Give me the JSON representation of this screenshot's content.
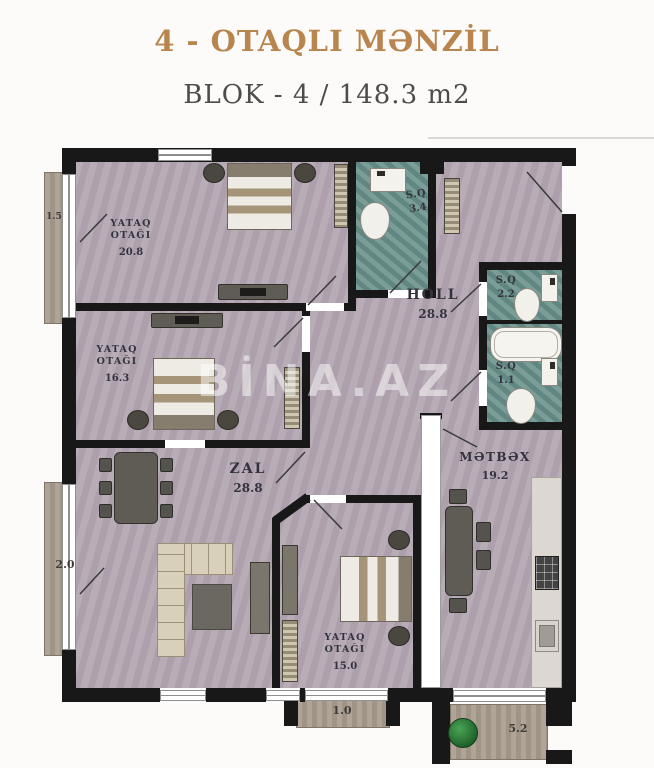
{
  "header": {
    "title": "4 - OTAQLI MƏNZİL",
    "subtitle": "BLOK - 4 /  148.3 m2"
  },
  "watermark": "BİNA.AZ",
  "rooms": {
    "bedroom1": {
      "name_line1": "YATAQ",
      "name_line2": "OTAĞI",
      "area": "20.8"
    },
    "bedroom2": {
      "name_line1": "YATAQ",
      "name_line2": "OTAĞI",
      "area": "16.3"
    },
    "bedroom3": {
      "name_line1": "YATAQ",
      "name_line2": "OTAĞI",
      "area": "15.0"
    },
    "hall": {
      "name": "HOLL",
      "area": "28.8"
    },
    "living_room": {
      "name": "ZAL",
      "area": "28.8"
    },
    "kitchen": {
      "name": "MƏTBƏX",
      "area": "19.2"
    },
    "bathroom_top": {
      "name": "S.Q",
      "area": "3.4"
    },
    "wc_right_upper": {
      "name": "S.Q",
      "area": "2.2"
    },
    "wc_right_lower": {
      "name": "S.Q",
      "area": "1.1"
    }
  },
  "balconies": {
    "top_left": {
      "dimension": "1.5"
    },
    "mid_left": {
      "dimension": "2.0"
    },
    "bottom_center": {
      "dimension": "1.0"
    },
    "bottom_right": {
      "dimension": "5.2"
    }
  },
  "colors": {
    "title_text": "#b9854e",
    "subtitle_text": "#4c4c4c",
    "wall": "#181818",
    "room_floor": "#b4a8b3",
    "wet_floor": "#69908a",
    "balcony_floor": "#a89c8e",
    "label_text": "#34323e"
  }
}
